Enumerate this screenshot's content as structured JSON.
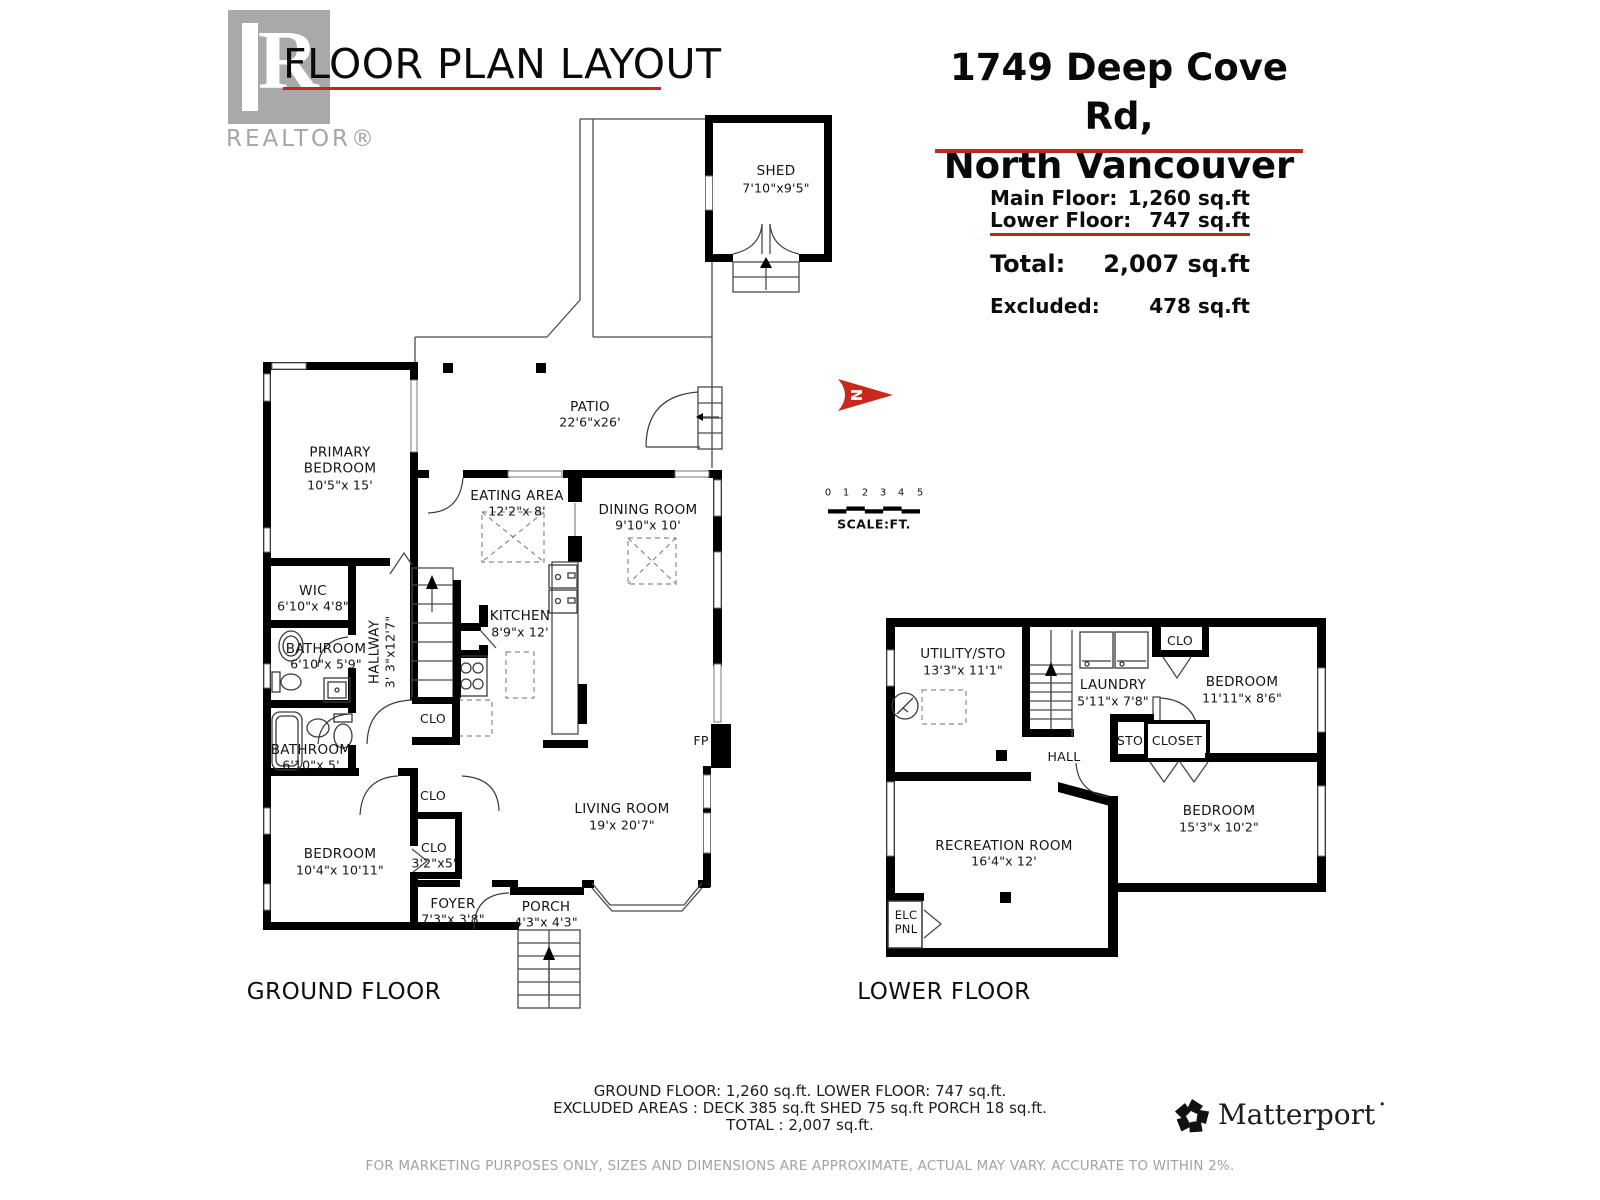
{
  "branding": {
    "realtor_glyph": "R",
    "realtor_text": "REALTOR®",
    "matterport_text": "Matterport˙"
  },
  "header": {
    "title": "FLOOR PLAN LAYOUT"
  },
  "address": {
    "line1": "1749 Deep Cove Rd,",
    "line2": "North Vancouver"
  },
  "summary": {
    "rows": [
      {
        "label": "Main Floor:",
        "value": "1,260 sq.ft"
      },
      {
        "label": "Lower Floor:",
        "value": "747 sq.ft"
      }
    ],
    "total_label": "Total:",
    "total_value": "2,007 sq.ft",
    "excluded_label": "Excluded:",
    "excluded_value": "478  sq.ft"
  },
  "compass": {
    "letter": "N"
  },
  "scale_bar": {
    "ticks": [
      "0",
      "1",
      "2",
      "3",
      "4",
      "5"
    ],
    "label": "SCALE:FT."
  },
  "ground_floor": {
    "label": "GROUND FLOOR",
    "rooms": {
      "shed": {
        "name": "SHED",
        "dims": "7'10\"x9'5\""
      },
      "patio": {
        "name": "PATIO",
        "dims": "22'6\"x26'"
      },
      "primary_bedroom": {
        "name": "PRIMARY BEDROOM",
        "dims": "10'5\"x 15'"
      },
      "eating_area": {
        "name": "EATING AREA",
        "dims": "12'2\"x 8'"
      },
      "dining_room": {
        "name": "DINING ROOM",
        "dims": "9'10\"x 10'"
      },
      "wic": {
        "name": "WIC",
        "dims": "6'10\"x 4'8\""
      },
      "bathroom1": {
        "name": "BATHROOM",
        "dims": "6'10\"x 5'9\""
      },
      "hallway": {
        "name": "HALLWAY",
        "dims": "3' 3\"x12'7\""
      },
      "kitchen": {
        "name": "KITCHEN",
        "dims": "8'9\"x 12'"
      },
      "clo_hall": {
        "name": "CLO"
      },
      "bathroom2": {
        "name": "BATHROOM",
        "dims": "6'10\"x 5'"
      },
      "fireplace": {
        "name": "FP"
      },
      "living_room": {
        "name": "LIVING ROOM",
        "dims": "19'x 20'7\""
      },
      "clo1": {
        "name": "CLO"
      },
      "clo2": {
        "name": "CLO",
        "dims": "3'2\"x5'"
      },
      "bedroom": {
        "name": "BEDROOM",
        "dims": "10'4\"x 10'11\""
      },
      "foyer": {
        "name": "FOYER",
        "dims": "7'3\"x 3'8\""
      },
      "porch": {
        "name": "PORCH",
        "dims": "4'3\"x 4'3\""
      }
    }
  },
  "lower_floor": {
    "label": "LOWER FLOOR",
    "rooms": {
      "utility": {
        "name": "UTILITY/STO",
        "dims": "13'3\"x 11'1\""
      },
      "laundry": {
        "name": "LAUNDRY",
        "dims": "5'11\"x 7'8\""
      },
      "clo": {
        "name": "CLO"
      },
      "bedroom1": {
        "name": "BEDROOM",
        "dims": "11'11\"x 8'6\""
      },
      "sto": {
        "name": "STO"
      },
      "closet": {
        "name": "CLOSET"
      },
      "hall": {
        "name": "HALL"
      },
      "bedroom2": {
        "name": "BEDROOM",
        "dims": "15'3\"x 10'2\""
      },
      "recreation": {
        "name": "RECREATION ROOM",
        "dims": "16'4\"x 12'"
      },
      "elc": {
        "name": "ELC PNL"
      }
    }
  },
  "footer": {
    "line1": "GROUND FLOOR: 1,260 sq.ft.  LOWER FLOOR: 747 sq.ft.",
    "line2": "EXCLUDED AREAS :  DECK 385 sq.ft  SHED 75 sq.ft  PORCH 18 sq.ft.",
    "line3": "TOTAL :  2,007 sq.ft.",
    "disclaimer": "FOR MARKETING PURPOSES ONLY, SIZES AND DIMENSIONS ARE APPROXIMATE, ACTUAL MAY VARY. ACCURATE TO WITHIN 2%."
  },
  "colors": {
    "accent_red": "#C0281E",
    "wall_black": "#000000",
    "logo_gray": "#A9A9A9",
    "muted_gray": "#A3A3A3"
  }
}
